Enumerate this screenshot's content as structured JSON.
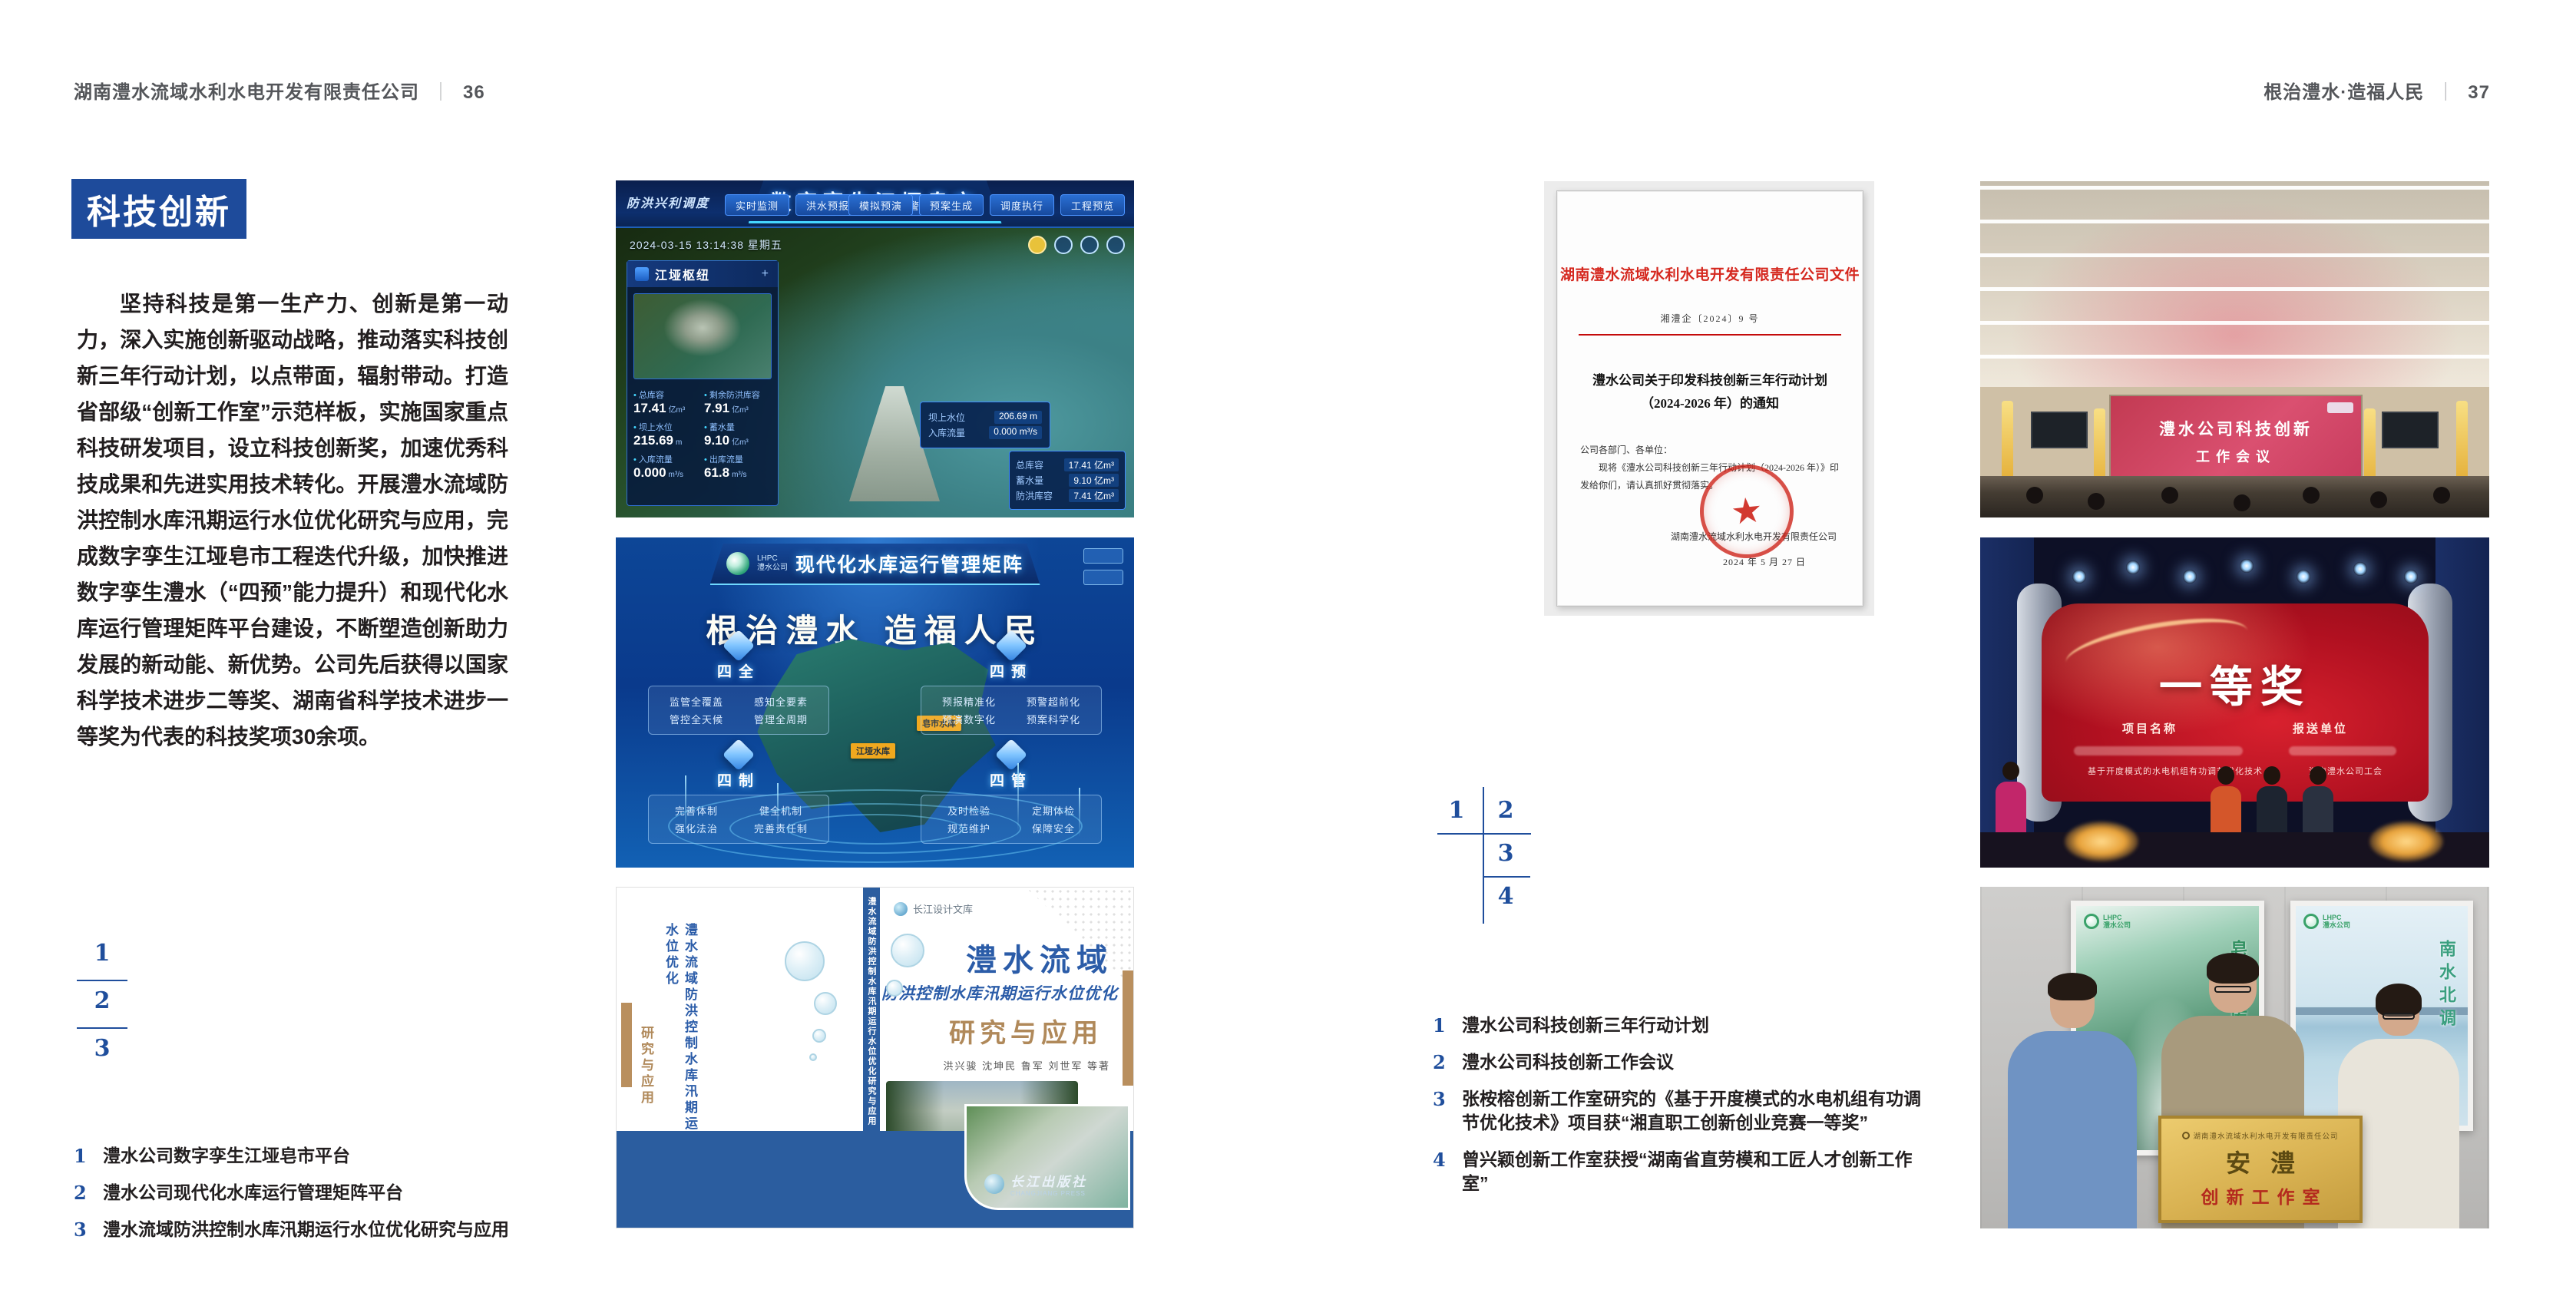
{
  "colors": {
    "accent_blue": "#1e4b9b",
    "caption_blue": "#1f4e9c",
    "doc_red": "#d5281f",
    "book_blue": "#2b5ca8",
    "book_tan": "#b0895a"
  },
  "left_page": {
    "header": {
      "company": "湖南澧水流域水利水电开发有限责任公司",
      "separator": "｜",
      "page_number": "36"
    },
    "badge": "科技创新",
    "paragraph": "坚持科技是第一生产力、创新是第一动力，深入实施创新驱动战略，推动落实科技创新三年行动计划，以点带面，辐射带动。打造省部级“创新工作室”示范样板，实施国家重点科技研发项目，设立科技创新奖，加速优秀科技成果和先进实用技术转化。开展澧水流域防洪控制水库汛期运行水位优化研究与应用，完成数字孪生江垭皂市工程迭代升级，加快推进数字孪生澧水（“四预”能力提升）和现代化水库运行管理矩阵平台建设，不断塑造创新助力发展的新动能、新优势。公司先后获得以国家科学技术进步二等奖、湖南省科学技术进步一等奖为代表的科技奖项30余项。",
    "figure_numbers": [
      "1",
      "2",
      "3"
    ],
    "captions": [
      {
        "num": "1",
        "text": "澧水公司数字孪生江垭皂市平台"
      },
      {
        "num": "2",
        "text": "澧水公司现代化水库运行管理矩阵平台"
      },
      {
        "num": "3",
        "text": "澧水流域防洪控制水库汛期运行水位优化研究与应用"
      }
    ]
  },
  "right_page": {
    "header": {
      "slogan": "根治澧水·造福人民",
      "separator": "｜",
      "page_number": "37"
    },
    "figure_numbers": [
      "1",
      "2",
      "3",
      "4"
    ],
    "captions": [
      {
        "num": "1",
        "text": "澧水公司科技创新三年行动计划"
      },
      {
        "num": "2",
        "text": "澧水公司科技创新工作会议"
      },
      {
        "num": "3",
        "text": "张桉榕创新工作室研究的《基于开度模式的水电机组有功调节优化技术》项目获“湘直职工创新创业竞赛一等奖”"
      },
      {
        "num": "4",
        "text": "曾兴颖创新工作室获授“湖南省直劳模和工匠人才创新工作室”"
      }
    ]
  },
  "fig_digital_twin": {
    "title": "数字孪生江垭皂市",
    "corner_label": "防洪兴利调度",
    "tabs_left": [
      "实时监测",
      "洪水预报",
      "防洪预警"
    ],
    "tabs_right": [
      "模拟预演",
      "预案生成",
      "调度执行",
      "工程预览"
    ],
    "timestamp": "2024-03-15 13:14:38 星期五",
    "panel_title": "江垭枢纽",
    "stats": [
      {
        "label": "总库容",
        "value": "17.41",
        "unit": "亿m³"
      },
      {
        "label": "剩余防洪库容",
        "value": "7.91",
        "unit": "亿m³"
      },
      {
        "label": "坝上水位",
        "value": "215.69",
        "unit": "m"
      },
      {
        "label": "蓄水量",
        "value": "9.10",
        "unit": "亿m³"
      },
      {
        "label": "入库流量",
        "value": "0.000",
        "unit": "m³/s"
      },
      {
        "label": "出库流量",
        "value": "61.8",
        "unit": "m³/s"
      }
    ],
    "tooltip": {
      "label1": "坝上水位",
      "value1": "206.69 m",
      "label2": "入库流量",
      "value2": "0.000 m³/s"
    },
    "side_rows": [
      {
        "label": "总库容",
        "value": "17.41 亿m³"
      },
      {
        "label": "蓄水量",
        "value": "9.10 亿m³"
      },
      {
        "label": "防洪库容",
        "value": "7.41 亿m³"
      }
    ]
  },
  "fig_matrix": {
    "logo_line1": "LHPC",
    "logo_line2": "澧水公司",
    "title": "现代化水库运行管理矩阵",
    "slogan": "根治澧水 造福人民",
    "quadrants": [
      {
        "name": "四全",
        "items": [
          "监管全覆盖",
          "感知全要素",
          "管控全天候",
          "管理全周期"
        ]
      },
      {
        "name": "四预",
        "items": [
          "预报精准化",
          "预警超前化",
          "预演数字化",
          "预案科学化"
        ]
      },
      {
        "name": "四制",
        "items": [
          "完善体制",
          "健全机制",
          "强化法治",
          "完善责任制"
        ]
      },
      {
        "name": "四管",
        "items": [
          "及时检验",
          "定期体检",
          "规范维护",
          "保障安全"
        ]
      }
    ],
    "map_labels": [
      "皂市水库",
      "江垭水库"
    ]
  },
  "fig_book": {
    "library": "长江设计文库",
    "title1": "澧水流域",
    "title2": "防洪控制水库汛期运行水位优化",
    "title3": "研究与应用",
    "authors": "洪兴骏 沈坤民 鲁军 刘世军 等著",
    "spine": "澧水流域防洪控制水库汛期运行水位优化研究与应用",
    "back_title": "澧水流域防洪控制水库汛期运行水位优化",
    "back_subtitle": "研究与应用",
    "publisher": "长江出版社",
    "publisher_en": "CHANGJIANG PRESS"
  },
  "fig_document": {
    "header": "湖南澧水流域水利水电开发有限责任公司文件",
    "doc_number": "湘澧企〔2024〕9 号",
    "title1": "澧水公司关于印发科技创新三年行动计划",
    "title2": "（2024-2026 年）的通知",
    "salutation": "公司各部门、各单位：",
    "body1": "现将《澧水公司科技创新三年行动计划（2024-2026 年）》印",
    "body2": "发给你们，请认真抓好贯彻落实。",
    "signature": "湖南澧水流域水利水电开发有限责任公司",
    "date": "2024 年 5 月 27 日",
    "seal_star": "★"
  },
  "fig_meeting": {
    "screen1": "澧水公司科技创新",
    "screen2": "工作会议"
  },
  "fig_award": {
    "headline": "一等奖",
    "col_project": "项目名称",
    "col_org": "报送单位",
    "project2": "基于开度模式的水电机组有功调节优化技术",
    "org2": "湖南澧水公司工会"
  },
  "fig_group": {
    "plaque_header": "湖南澧水流域水利水电开发有限责任公司",
    "plaque_title": "安澧",
    "plaque_subtitle": "创新工作室",
    "poster_left_label": "皂市水库",
    "poster_right_label": "南水北调"
  }
}
